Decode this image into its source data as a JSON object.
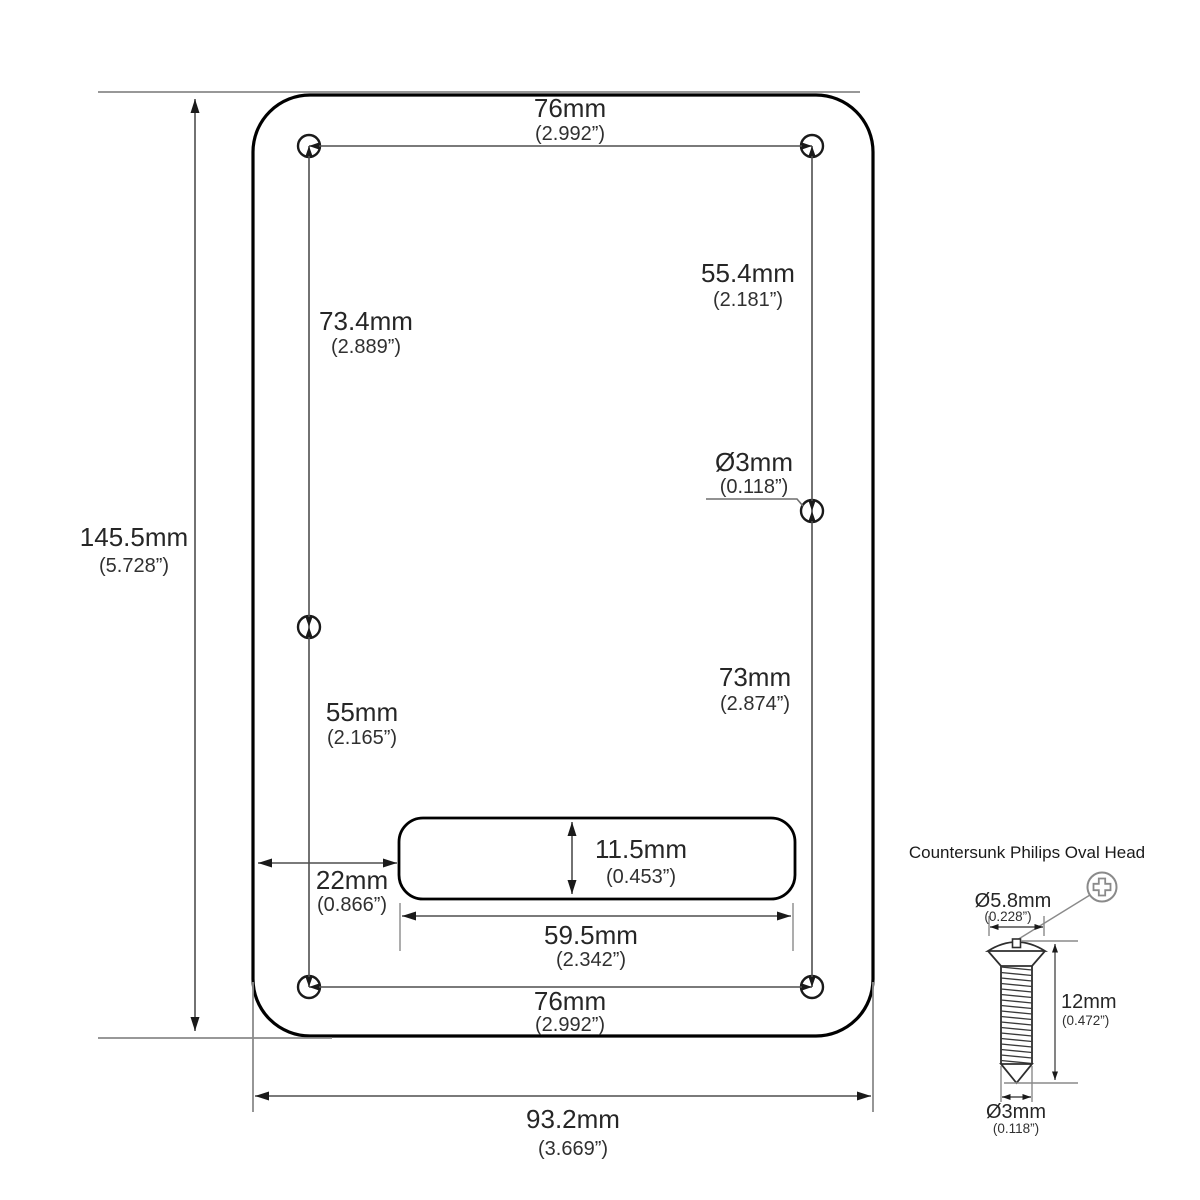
{
  "plate": {
    "fill": "#ececec",
    "slot_fill": "#ffffff",
    "hole_fill": "#ffffff",
    "dims": {
      "top_width_mm": "76mm",
      "top_width_in": "(2.992”)",
      "upper_left_mm": "73.4mm",
      "upper_left_in": "(2.889”)",
      "upper_right_mm": "55.4mm",
      "upper_right_in": "(2.181”)",
      "hole_dia_mm": "Ø3mm",
      "hole_dia_in": "(0.118”)",
      "height_mm": "145.5mm",
      "height_in": "(5.728”)",
      "lower_right_mm": "73mm",
      "lower_right_in": "(2.874”)",
      "lower_left_mm": "55mm",
      "lower_left_in": "(2.165”)",
      "slot_height_mm": "11.5mm",
      "slot_height_in": "(0.453”)",
      "slot_offset_mm": "22mm",
      "slot_offset_in": "(0.866”)",
      "slot_width_mm": "59.5mm",
      "slot_width_in": "(2.342”)",
      "bottom_width_mm": "76mm",
      "bottom_width_in": "(2.992”)",
      "overall_width_mm": "93.2mm",
      "overall_width_in": "(3.669”)"
    }
  },
  "screw": {
    "title": "Countersunk Philips Oval Head",
    "head_dia_mm": "Ø5.8mm",
    "head_dia_in": "(0.228”)",
    "length_mm": "12mm",
    "length_in": "(0.472”)",
    "thread_dia_mm": "Ø3mm",
    "thread_dia_in": "(0.118”)"
  },
  "colors": {
    "plate_fill": "#ececec",
    "outline": "#000000",
    "dimension_line": "#4f4f4f",
    "extension_line": "#8a8a8a",
    "text": "#262626"
  }
}
